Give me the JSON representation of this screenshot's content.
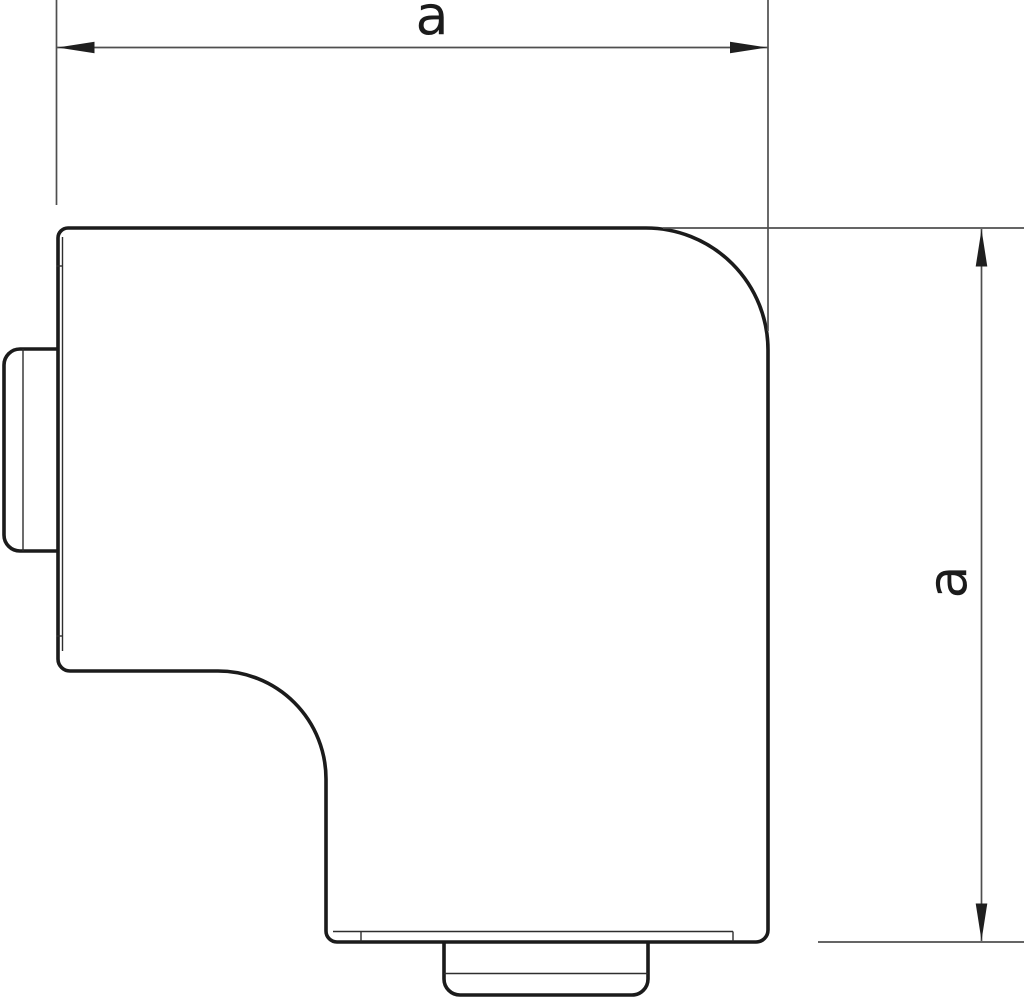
{
  "drawing": {
    "kind": "technical-line-drawing",
    "top_dimension": {
      "label": "a"
    },
    "right_dimension": {
      "label": "a"
    },
    "colors": {
      "outline": "#1b1b1b",
      "detail_line": "#2e2e2e",
      "dimension_line": "#4f4f4f",
      "arrowhead": "#1f1f1f",
      "label": "#1b1b1b",
      "background": "#ffffff"
    }
  }
}
